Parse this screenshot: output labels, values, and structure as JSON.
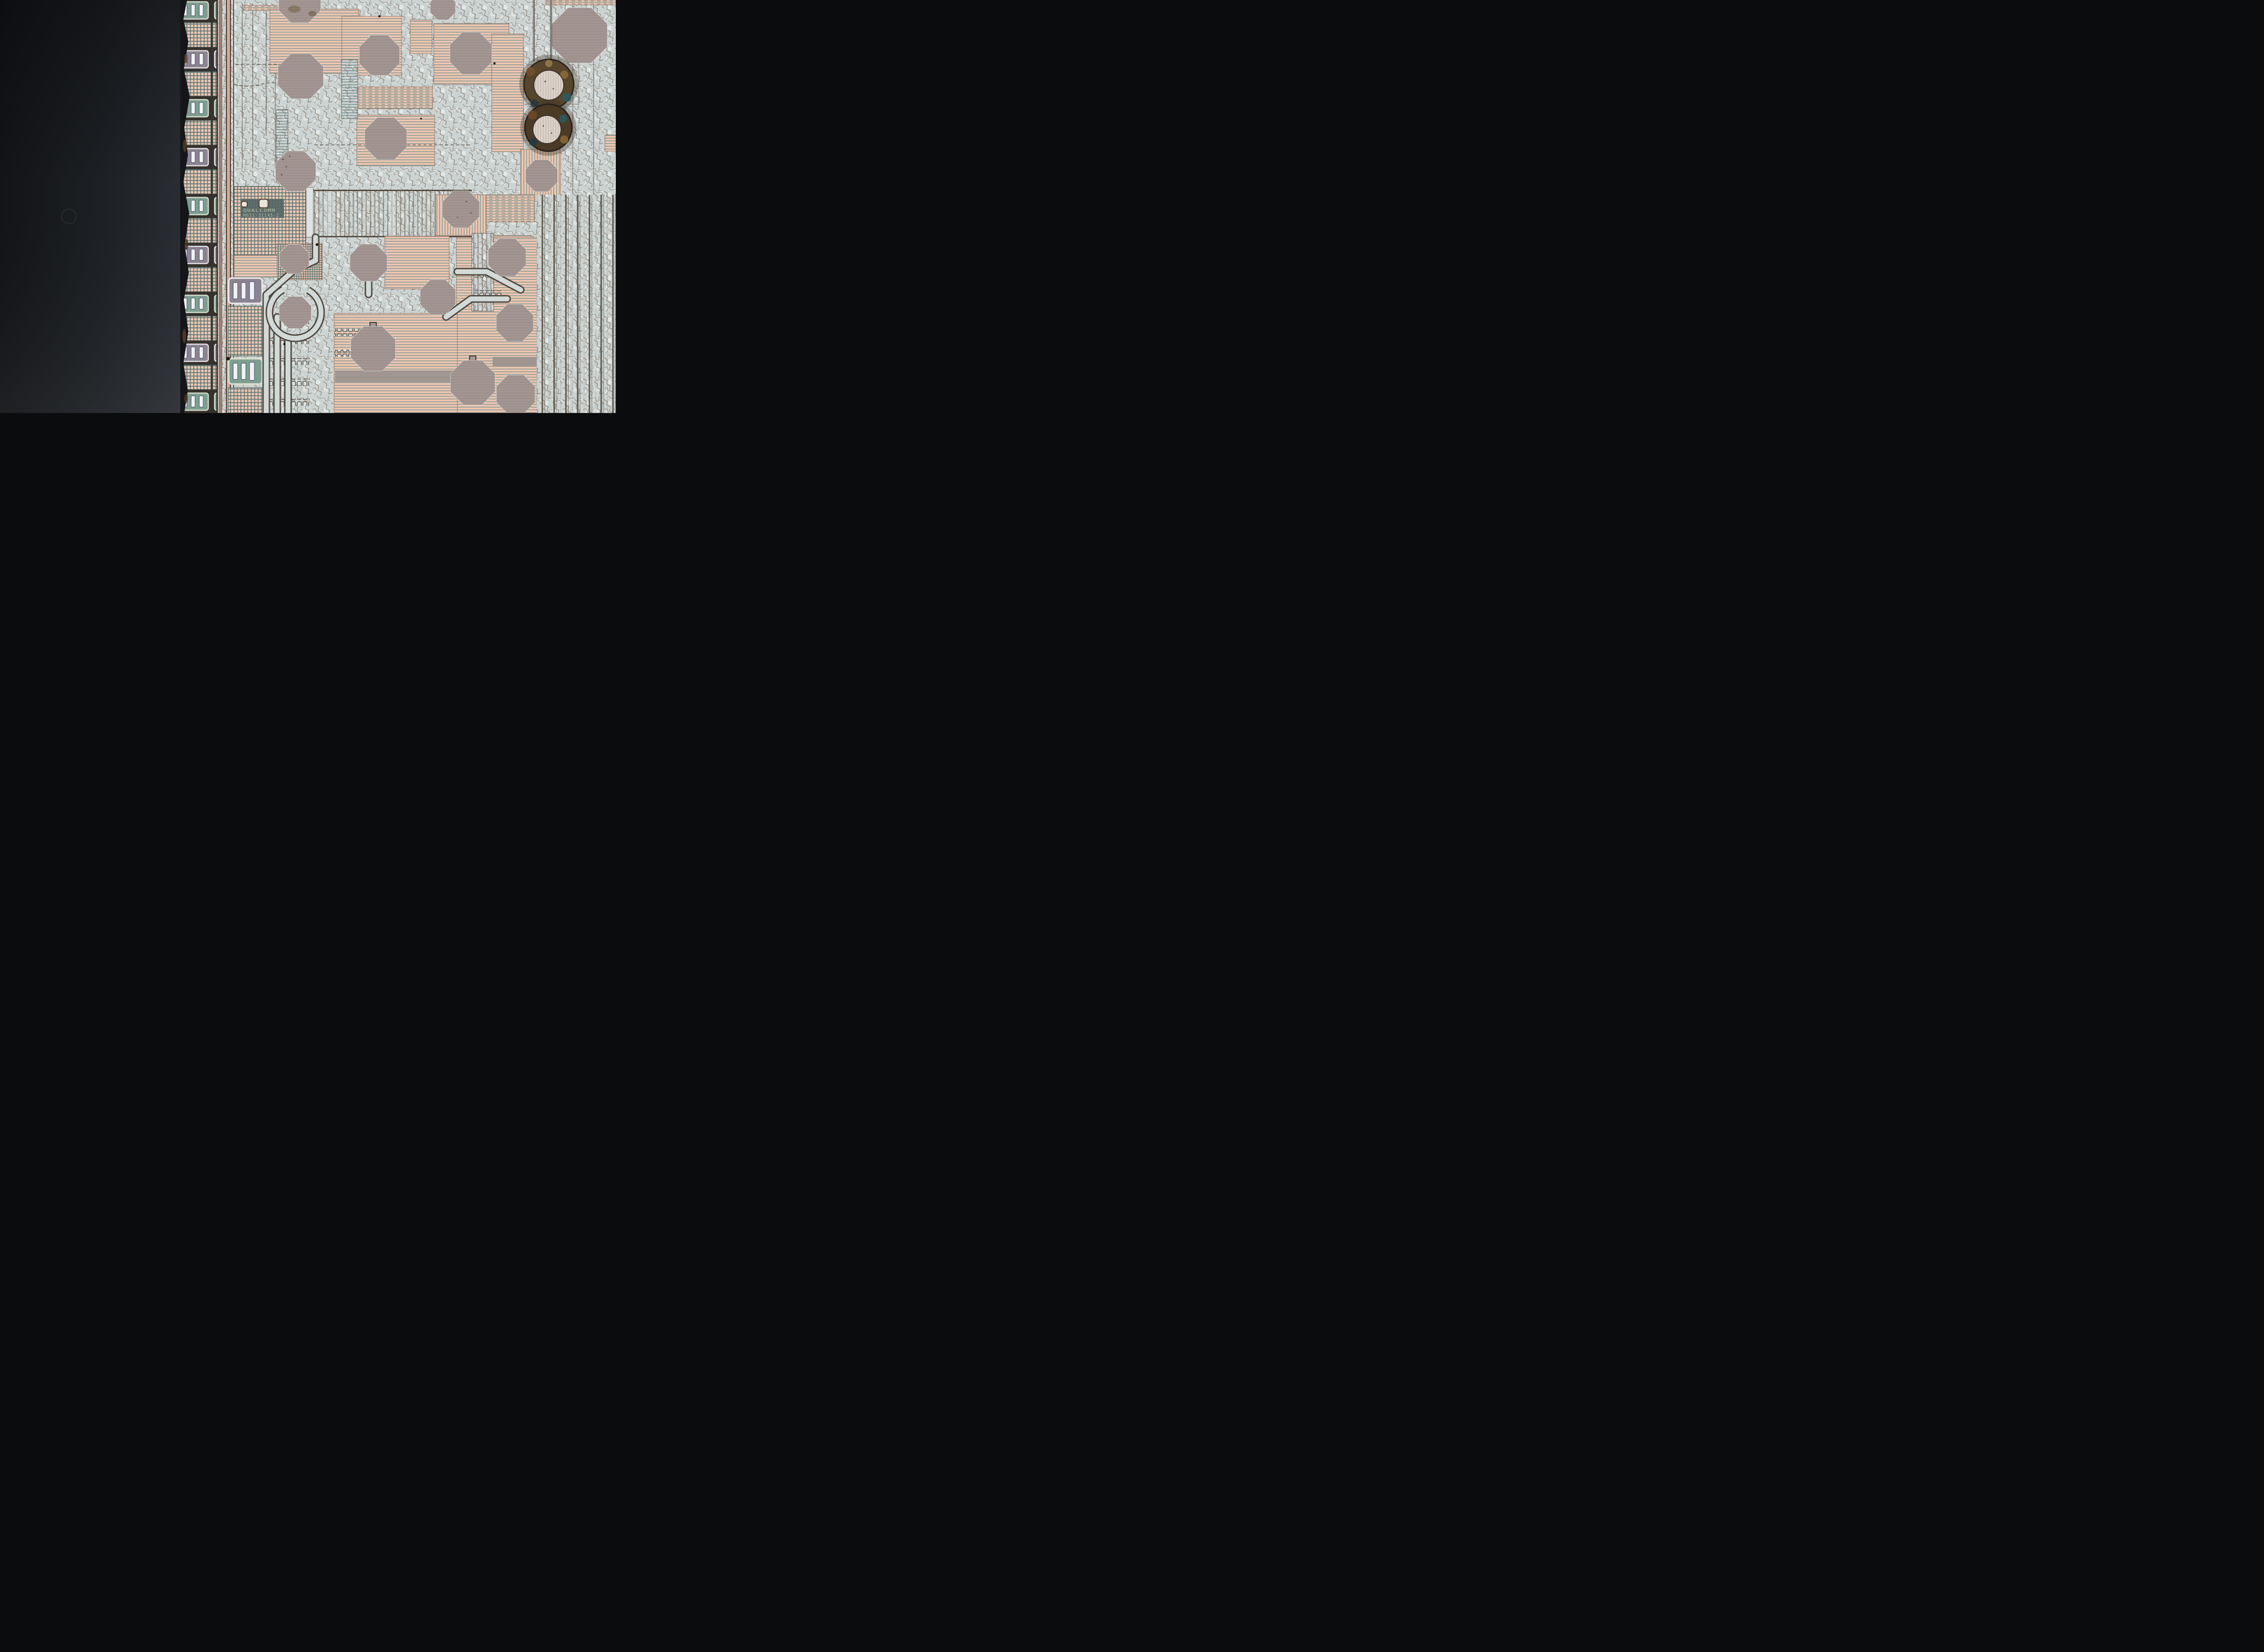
{
  "die_marking": {
    "line1": "QUALCOMM",
    "line2": "HG11-31145-2"
  },
  "colors": {
    "background_dark_left": "#17191d",
    "die_edge_shadow": "#101113",
    "metal_silver": "#ccd4d3",
    "metal_bright": "#edf2f0",
    "crack_line": "#7a6c5f",
    "pad_peach": "#eec6b0",
    "stripe_teal": "#7f9894",
    "grid_teal": "#5d7a7a",
    "octagon_gray": "#a39692",
    "octagon_outline": "#38332d",
    "marking_panel": "#50616b",
    "marking_text": "#c6cdac",
    "marking_dots": "#a9b464",
    "seam_copper": "#97795f",
    "ring_corrosion": "#59422a",
    "ring_center": "#ddd3cb",
    "green_cell": "#7e9f90",
    "cell_bar_white": "#eff1f4"
  }
}
